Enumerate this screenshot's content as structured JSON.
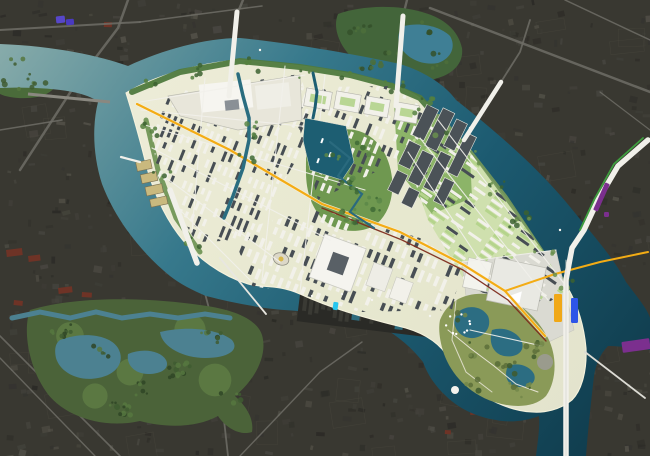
{
  "title": "Aerial masterplan rendering of a river-island district over a dark satellite photo",
  "image": {
    "width": 650,
    "height": 456,
    "kind": "masterplan aerial photomontage",
    "visible_text": "none"
  },
  "palette": {
    "satellite_base": "#393831",
    "satellite_block_dark": "#262520",
    "satellite_block_light": "#4c4a43",
    "satellite_road": "#6f6d66",
    "river_light": "#8fb0ad",
    "river_mid": "#37798c",
    "river_deep": "#1c5a70",
    "river_darkest": "#0e3848",
    "pond_teal": "#4c8191",
    "island_ground": "#eae9d3",
    "island_ground_green": "#cfe0ae",
    "plaza_gray": "#dadad2",
    "park_green": "#6f9850",
    "park_olive": "#8a9a58",
    "shore_trees": "#4f7a3e",
    "tree_dark": "#3c6130",
    "tree_light": "#55803e",
    "building_white": "#f2f1ea",
    "building_dark": "#474e54",
    "quay_tan": "#c9b97e",
    "road_white": "#f1f0ea",
    "road_yellow": "#f3ac15",
    "road_red": "#7e2c1c",
    "road_green_stripe": "#3f9f3f",
    "canal_teal": "#1d5e72",
    "basin_teal": "#1d5e72",
    "red_roof": "#6e3326"
  },
  "markers": [
    {
      "name": "orange-zone-marker",
      "color": "#f0a817",
      "x": 554,
      "y": 294,
      "w": 8,
      "h": 28,
      "rot": 0
    },
    {
      "name": "blue-zone-marker",
      "color": "#2e55e8",
      "x": 571,
      "y": 298,
      "w": 7,
      "h": 25,
      "rot": 0
    },
    {
      "name": "purple-road-marker",
      "color": "#7b2f8e",
      "x": 599,
      "y": 182,
      "w": 5,
      "h": 30,
      "rot": 24
    },
    {
      "name": "purple-dot-marker",
      "color": "#7b2f8e",
      "x": 604,
      "y": 212,
      "w": 5,
      "h": 5,
      "rot": 0
    },
    {
      "name": "purple-bank-marker",
      "color": "#7b2f8e",
      "x": 622,
      "y": 340,
      "w": 28,
      "h": 11,
      "rot": -8
    },
    {
      "name": "cyan-dock-marker",
      "color": "#27c6ee",
      "x": 333,
      "y": 302,
      "w": 5,
      "h": 8,
      "rot": 8
    },
    {
      "name": "violet-roof-marker",
      "color": "#5747c9",
      "x": 56,
      "y": 16,
      "w": 9,
      "h": 7,
      "rot": -6
    },
    {
      "name": "violet-roof-marker-2",
      "color": "#4a3ac0",
      "x": 66,
      "y": 19,
      "w": 8,
      "h": 6,
      "rot": -6
    }
  ],
  "regions": [
    "north-river",
    "west-river-branch",
    "southeast-river",
    "south-channel",
    "island-masterplan",
    "northwest-housing-district",
    "north-perimeter-blocks",
    "central-park-with-moat",
    "slab-park",
    "northeast-residential-district",
    "south-central-district",
    "courtyard-landmark-building",
    "southeast-plaza",
    "southern-tip-park",
    "harbor-basin",
    "inner-canal",
    "main-yellow-road",
    "north-bridge-west",
    "north-bridge-east",
    "northeast-bridge",
    "southwest-bridge",
    "vertical-east-road-bridge",
    "mainland-pond-park",
    "northeast-mainland-grove",
    "boat-shed-waterfront"
  ]
}
